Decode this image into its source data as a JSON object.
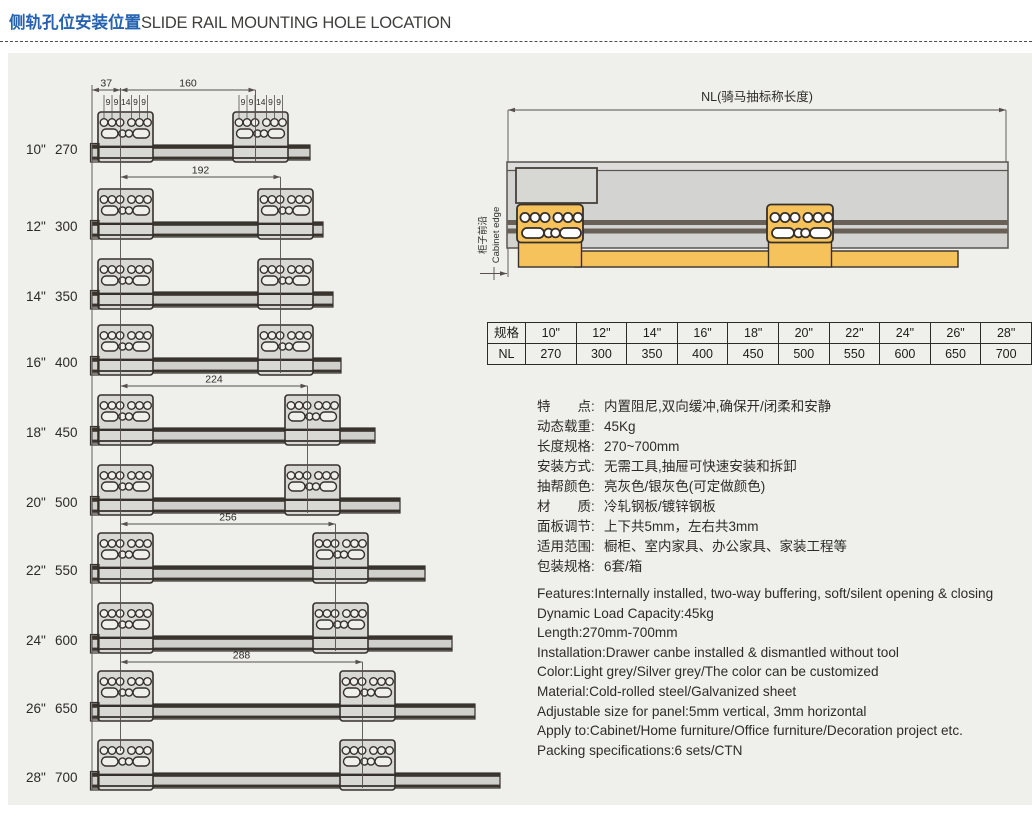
{
  "title": {
    "zh": "侧轨孔位安装位置",
    "en": "SLIDE RAIL MOUNTING HOLE LOCATION"
  },
  "colors": {
    "accent_blue": "#2563b0",
    "orange": "#f6c25c",
    "line_dark": "#35302b",
    "panel_bg": "#efefec",
    "bracket_fill": "#d8d8d5",
    "rail_fill": "#cfcfcc",
    "stripe_dark": "#3a342e",
    "body_grey": "#d3d3d1",
    "dim_line": "#55504b"
  },
  "left_diagram": {
    "edge_dim": "37",
    "hole_spacing_labels": [
      "9",
      "9",
      "14",
      "9",
      "9"
    ],
    "rails": [
      {
        "size": "10\"",
        "nl": "270",
        "hole_span": "160"
      },
      {
        "size": "12\"",
        "nl": "300",
        "hole_span": "192"
      },
      {
        "size": "14\"",
        "nl": "350",
        "hole_span": "192"
      },
      {
        "size": "16\"",
        "nl": "400",
        "hole_span": "192"
      },
      {
        "size": "18\"",
        "nl": "450",
        "hole_span": "224"
      },
      {
        "size": "20\"",
        "nl": "500",
        "hole_span": "224"
      },
      {
        "size": "22\"",
        "nl": "550",
        "hole_span": "256"
      },
      {
        "size": "24\"",
        "nl": "600",
        "hole_span": "256"
      },
      {
        "size": "26\"",
        "nl": "650",
        "hole_span": "288"
      },
      {
        "size": "28\"",
        "nl": "700",
        "hole_span": "288"
      }
    ]
  },
  "right_diagram": {
    "nl_dim_label": "NL(骑马抽标称长度)",
    "cabinet_edge_zh": "柜子前沿",
    "cabinet_edge_en": "Cabinet edge"
  },
  "table": {
    "rows": [
      [
        "规格",
        "10\"",
        "12\"",
        "14\"",
        "16\"",
        "18\"",
        "20\"",
        "22\"",
        "24\"",
        "26\"",
        "28\""
      ],
      [
        "NL",
        "270",
        "300",
        "350",
        "400",
        "450",
        "500",
        "550",
        "600",
        "650",
        "700"
      ]
    ]
  },
  "specs_zh": [
    {
      "label": "特　　点:",
      "value": "内置阻尼,双向缓冲,确保开/闭柔和安静"
    },
    {
      "label": "动态载重:",
      "value": "45Kg"
    },
    {
      "label": "长度规格:",
      "value": "270~700mm"
    },
    {
      "label": "安装方式:",
      "value": "无需工具,抽屉可快速安装和拆卸"
    },
    {
      "label": "抽帮颜色:",
      "value": "亮灰色/银灰色(可定做颜色)"
    },
    {
      "label": "材　　质:",
      "value": "冷轧钢板/镀锌钢板"
    },
    {
      "label": "面板调节:",
      "value": "上下共5mm，左右共3mm"
    },
    {
      "label": "适用范围:",
      "value": "橱柜、室内家具、办公家具、家装工程等"
    },
    {
      "label": "包装规格:",
      "value": "6套/箱"
    }
  ],
  "specs_en": [
    "Features:Internally installed, two-way buffering, soft/silent opening & closing",
    "Dynamic Load Capacity:45kg",
    "Length:270mm-700mm",
    "Installation:Drawer canbe installed & dismantled without tool",
    "Color:Light grey/Silver grey/The color can be customized",
    "Material:Cold-rolled steel/Galvanized sheet",
    "Adjustable size for panel:5mm vertical, 3mm horizontal",
    "Apply to:Cabinet/Home furniture/Office furniture/Decoration project etc.",
    "Packing specifications:6 sets/CTN"
  ]
}
